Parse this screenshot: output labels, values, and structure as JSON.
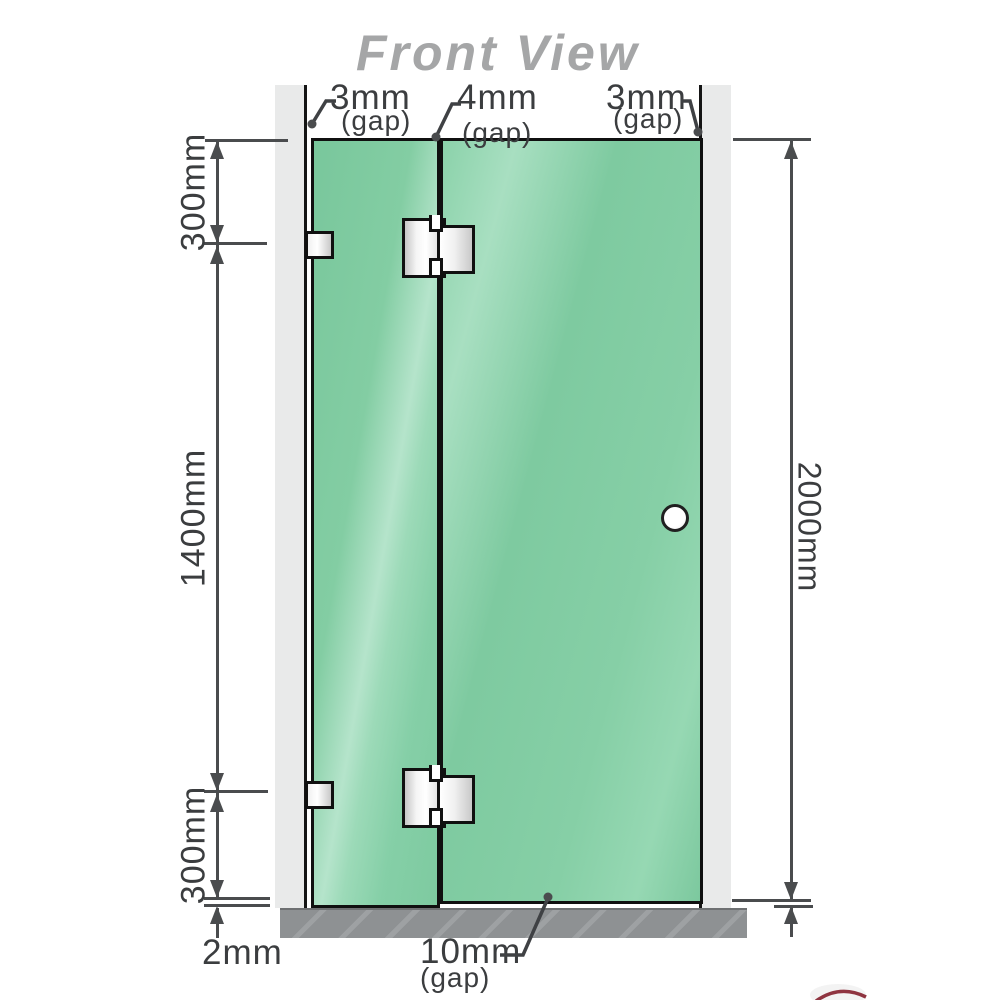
{
  "title": "Front View",
  "annotations": {
    "top_gaps": [
      {
        "value": "3mm",
        "note": "(gap)"
      },
      {
        "value": "4mm",
        "note": "(gap)"
      },
      {
        "value": "3mm",
        "note": "(gap)"
      }
    ],
    "left_dimensions": {
      "top": "300mm",
      "middle": "1400mm",
      "bottom": "300mm",
      "base_gap": "2mm"
    },
    "right_dimension": "2000mm",
    "bottom_gap": {
      "value": "10mm",
      "note": "(gap)"
    }
  },
  "colors": {
    "glass_green": "#85cfa6",
    "glass_highlight": "#b5e4cb",
    "wall_gray": "#e9eaea",
    "base_gray": "#8e9193",
    "dimension_line": "#4a4c4e",
    "title_gray": "#a5a6a7",
    "hardware_metal": "#f0f0f0"
  }
}
